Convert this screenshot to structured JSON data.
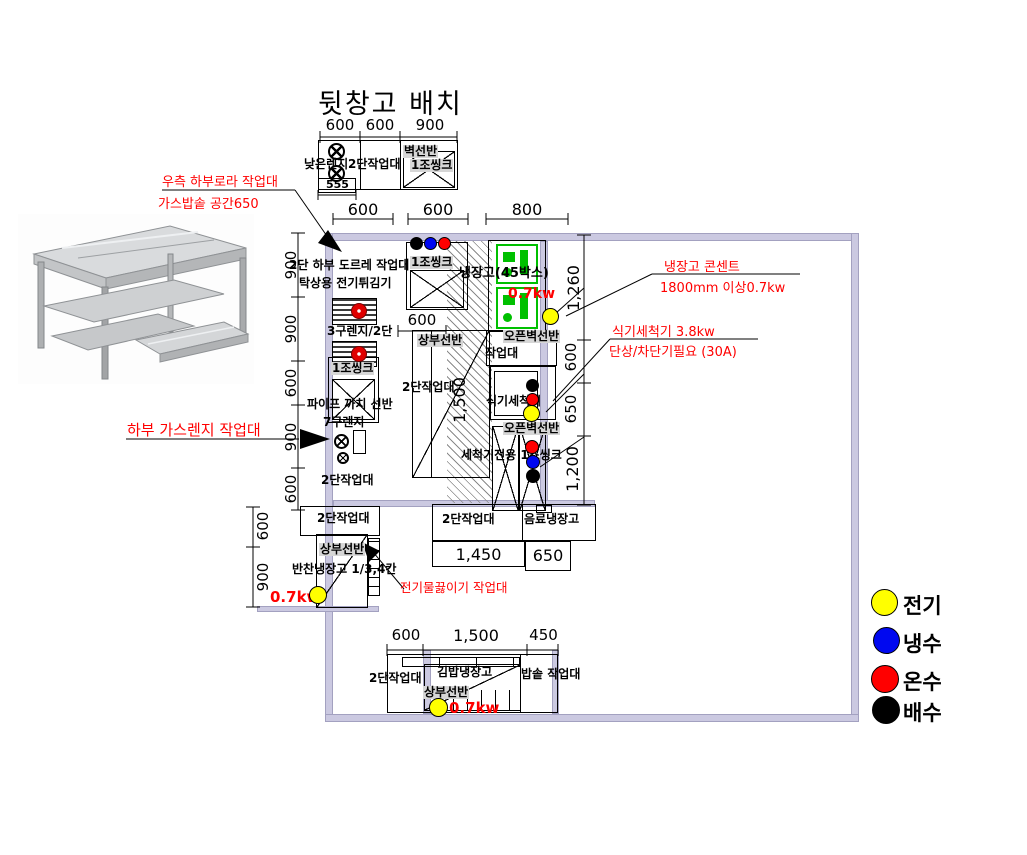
{
  "title": "뒷창고 배치",
  "top_unit": {
    "dims": [
      "600",
      "600",
      "900"
    ],
    "low_range": "낮은렌지",
    "worktable": "2단작업대",
    "wall_shelf": "벽선반",
    "sink": "1조씽크",
    "sub_dim": "555"
  },
  "annotations": {
    "right_table_1": "우측 하부로라 작업대",
    "right_table_2": "가스밥솥 공간650",
    "fridge_outlet_1": "냉장고 콘센트",
    "fridge_outlet_2": "1800mm 이상0.7kw",
    "dishwasher_1": "식기세척기 3.8kw",
    "dishwasher_2": "단상/차단기필요 (30A)",
    "gas_range": "하부 가스렌지 작업대",
    "kettle": "전기물끓이기 작업대"
  },
  "plan": {
    "top_dims": [
      "600",
      "600",
      "800"
    ],
    "left_dims": [
      "900",
      "900",
      "600",
      "900",
      "600"
    ],
    "right_dims": [
      "1,260",
      "600",
      "650",
      "1,200"
    ],
    "mid_dim": "600",
    "work_dim": "1,500",
    "row_dim_1": "1,450",
    "row_dim_2": "650",
    "top_sink": "1조씽크",
    "fridge": "냉장고(45박스)",
    "fridge_kw": "0.7kw",
    "pulley_table_1": "2단 하부 도르레 작업대",
    "pulley_table_2": "탁상용 전기튀김기",
    "range3": "3구렌지/2단",
    "left_sink": "1조씽크",
    "pipe_shelf": "파이프 까치 선반",
    "range7": "7구렌지",
    "left_worktable": "2단작업대",
    "upper_shelf": "상부선반",
    "mid_worktable": "2단작업대",
    "open_shelf_1": "오픈벽선반",
    "small_worktable": "작업대",
    "dishwasher": "식기세척기",
    "open_shelf_2": "오픈벽선반",
    "washer_sink": "세척기전용 1조씽크",
    "bottom_worktable": "2단작업대",
    "drink_fridge": "음료냉장고"
  },
  "annex": {
    "dims": [
      "600",
      "900"
    ],
    "worktable": "2단작업대",
    "shelf": "상부선반",
    "fridge": "반찬냉장고 1/3,4칸",
    "kw": "0.7kw"
  },
  "bottom": {
    "dims": [
      "600",
      "1,500",
      "450"
    ],
    "worktable": "2단작업대",
    "kimbap_fridge": "김밥냉장고",
    "shelf": "상부선반",
    "rice_table": "밥솥 작업대",
    "kw": "0.7kw"
  },
  "legend": {
    "items": [
      {
        "name": "electric",
        "label": "전기",
        "color": "#ffff00"
      },
      {
        "name": "cold-water",
        "label": "냉수",
        "color": "#0000ff"
      },
      {
        "name": "hot-water",
        "label": "온수",
        "color": "#ff0000"
      },
      {
        "name": "drain",
        "label": "배수",
        "color": "#000000"
      }
    ]
  },
  "colors": {
    "wall": "#cbc9e1",
    "highlight": "#d6d6d6",
    "annotation_red": "#ff0000",
    "fridge_green": "#00c000",
    "electric": "#ffff00",
    "cold": "#0000ff",
    "hot": "#ff0000",
    "drain": "#000000"
  }
}
